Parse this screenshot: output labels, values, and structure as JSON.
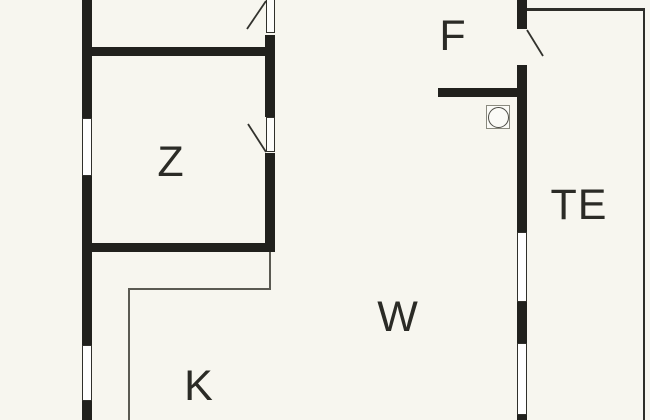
{
  "floorplan": {
    "type": "floor-plan",
    "colors": {
      "background": "#f7f6ef",
      "wall": "#21211d",
      "thin_line": "#2e2e29",
      "kitchen_line": "#5b5a52",
      "label": "#2b2b26",
      "window_fill": "#ffffff",
      "appliance_outline": "#8a8a7f"
    },
    "rooms": {
      "f": {
        "label": "F"
      },
      "z": {
        "label": "Z"
      },
      "w": {
        "label": "W"
      },
      "k": {
        "label": "K"
      },
      "te": {
        "label": "TE"
      }
    },
    "symbols": {
      "appliance": "circle-in-square"
    },
    "counts": {
      "windows": 4,
      "doors": 3
    }
  }
}
